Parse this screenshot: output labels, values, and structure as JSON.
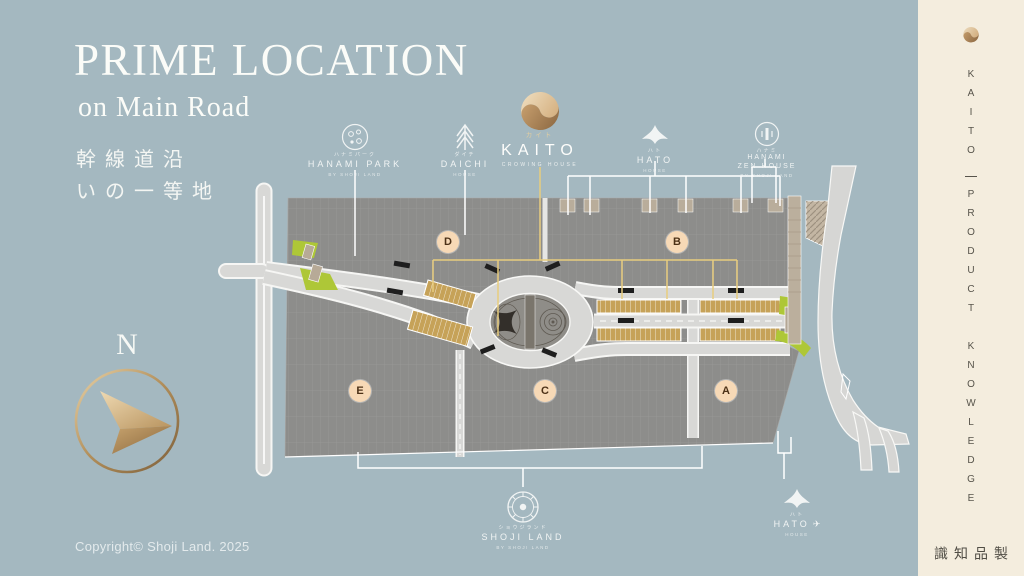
{
  "colors": {
    "background": "#a4b8c0",
    "sidebar": "#f4edde",
    "accent_gold": "#c79f6e",
    "leader_yellow": "#e8cd7e",
    "map_land": "#8d8d8b",
    "map_road": "#d8d8d6",
    "map_green": "#aec737",
    "shop_gold": "#c6a258",
    "label_bg": "#f7d9b6"
  },
  "header": {
    "title": "PRIME LOCATION",
    "subtitle": "on Main Road",
    "jp_line1": "幹線道沿",
    "jp_line2": "いの一等地"
  },
  "compass": {
    "label": "N"
  },
  "footer": {
    "copyright": "Copyright© Shoji Land. 2025"
  },
  "sidebar": {
    "brand": "KAITO",
    "tagline": "PRODUCT KNOWLEDGE",
    "jp": "製品知識"
  },
  "map": {
    "zones": [
      {
        "label": "D"
      },
      {
        "label": "B"
      },
      {
        "label": "E"
      },
      {
        "label": "C"
      },
      {
        "label": "A"
      }
    ]
  },
  "logos": {
    "hanami_park": {
      "jp": "ハナミパーク",
      "name": "HANAMI PARK",
      "sub": "BY SHOJI LAND"
    },
    "daichi": {
      "jp": "ダイチ",
      "name": "DAICHI",
      "sub": "HOUSE"
    },
    "kaito": {
      "jp": "カイト",
      "name": "KAITO",
      "sub": "CROWING HOUSE"
    },
    "hato_top": {
      "jp": "ハト",
      "name": "HATO",
      "sub": "HOUSE"
    },
    "hanami_zen": {
      "jp": "ハナミ",
      "name": "HANAMI",
      "name2": "ZEN HOUSE",
      "sub": "BY SHOJI LAND"
    },
    "shoji_land": {
      "jp": "ショウジランド",
      "name": "SHOJI LAND",
      "sub": "BY SHOJI LAND"
    },
    "hato_bottom": {
      "jp": "ハト",
      "name": "HATO",
      "plane": "✈",
      "sub": "HOUSE"
    }
  }
}
